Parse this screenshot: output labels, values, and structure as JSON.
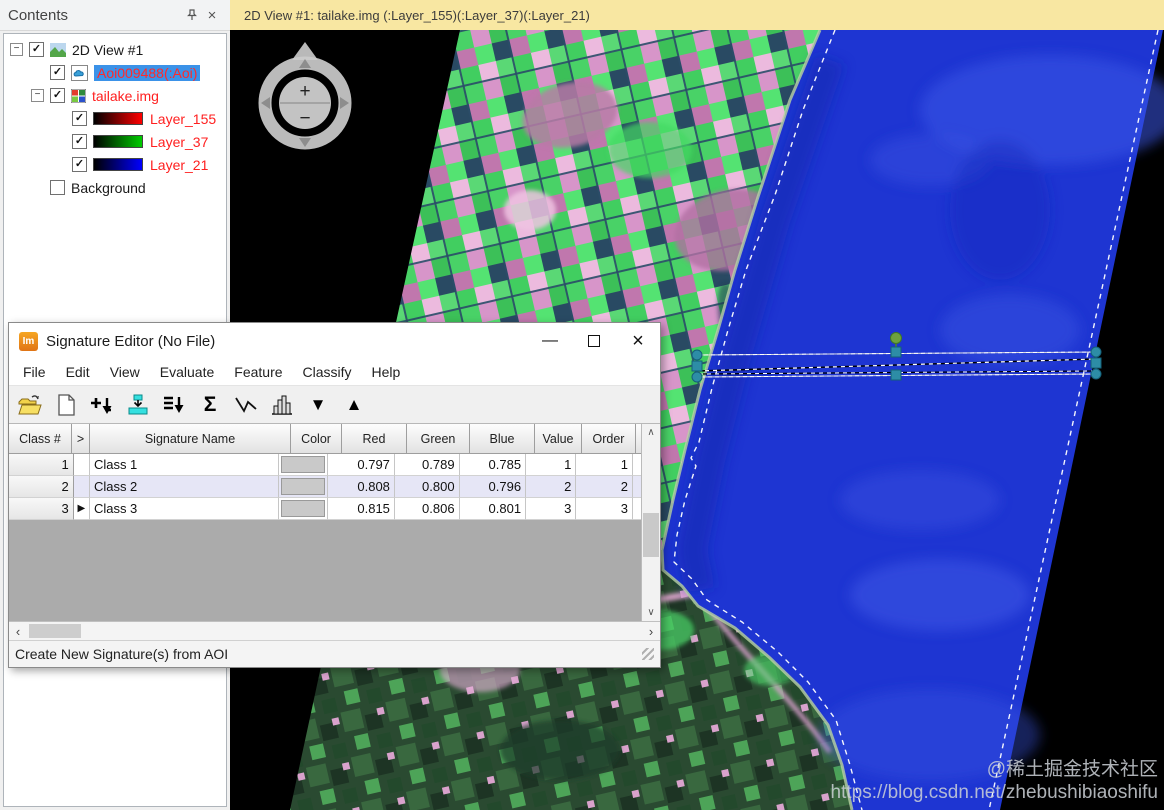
{
  "contents_panel": {
    "title": "Contents",
    "tree": {
      "view_label": "2D View #1",
      "items": [
        {
          "label": "Aoi009488(:Aoi)",
          "checked": true,
          "selected": true
        },
        {
          "label": "tailake.img",
          "checked": true,
          "selected": false
        },
        {
          "label": "Layer_155",
          "checked": true,
          "ramp": "red"
        },
        {
          "label": "Layer_37",
          "checked": true,
          "ramp": "green"
        },
        {
          "label": "Layer_21",
          "checked": true,
          "ramp": "blue"
        },
        {
          "label": "Background",
          "checked": false,
          "selected": false
        }
      ]
    }
  },
  "viewer": {
    "titlebar": "2D View #1: tailake.img (:Layer_155)(:Layer_37)(:Layer_21)",
    "compass": {
      "zoom_in": "+",
      "zoom_out": "−"
    }
  },
  "signature_editor": {
    "title": "Signature Editor (No File)",
    "window_controls": {
      "minimize": "—",
      "close": "×"
    },
    "menu": [
      "File",
      "Edit",
      "View",
      "Evaluate",
      "Feature",
      "Classify",
      "Help"
    ],
    "toolbar_icons": [
      "open-folder",
      "new-document",
      "add-signature",
      "merge-signatures",
      "replace-signature",
      "statistics-sigma",
      "profile-polyline",
      "histogram",
      "move-down",
      "move-up"
    ],
    "table": {
      "columns": [
        "Class #",
        ">",
        "Signature Name",
        "Color",
        "Red",
        "Green",
        "Blue",
        "Value",
        "Order"
      ],
      "rows": [
        {
          "class_num": "1",
          "marker": "",
          "name": "Class 1",
          "color": "#c9c9c9",
          "red": "0.797",
          "green": "0.789",
          "blue": "0.785",
          "value": "1",
          "order": "1"
        },
        {
          "class_num": "2",
          "marker": "",
          "name": "Class 2",
          "color": "#c9c9c9",
          "red": "0.808",
          "green": "0.800",
          "blue": "0.796",
          "value": "2",
          "order": "2"
        },
        {
          "class_num": "3",
          "marker": "▶",
          "name": "Class 3",
          "color": "#c9c9c9",
          "red": "0.815",
          "green": "0.806",
          "blue": "0.801",
          "value": "3",
          "order": "3"
        }
      ]
    },
    "scroll_glyphs": {
      "up": "∧",
      "down": "∨",
      "left": "‹",
      "right": "›"
    },
    "status_text": "Create New Signature(s) from AOI"
  },
  "watermark": {
    "line1": "@稀土掘金技术社区",
    "line2": "https://blog.csdn.net/zhebushibiaoshifu"
  },
  "colors": {
    "viewer_titlebar": "#f8e7a2",
    "selection_highlight": "#3b92e8",
    "layer_text": "#ff1f1f",
    "lake": "#1e35d2",
    "handle_teal": "#2d8da6",
    "handle_green": "#6da23e"
  }
}
